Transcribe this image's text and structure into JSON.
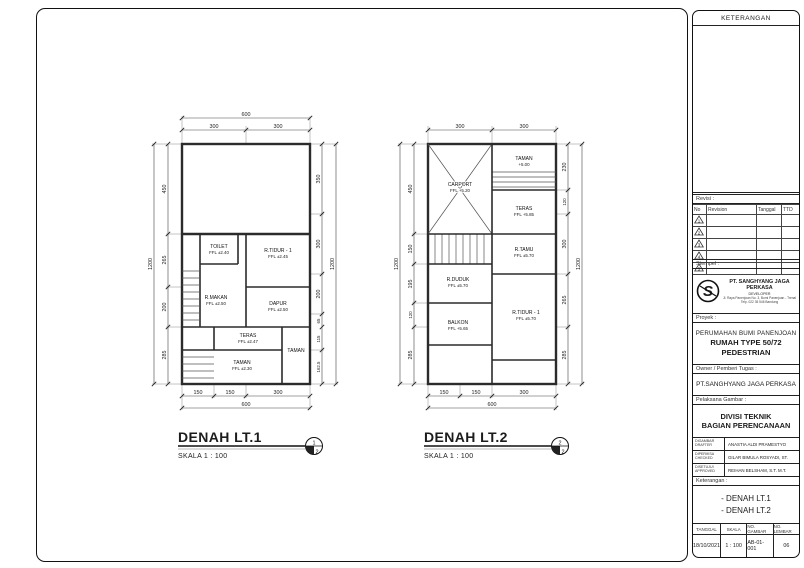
{
  "plan1": {
    "title": "DENAH LT.1",
    "scale": "SKALA 1 : 100",
    "ref_top": "1",
    "ref_bottom": "2",
    "dims": {
      "top_total": "600",
      "top": [
        "300",
        "300"
      ],
      "left_total": "1200",
      "left": [
        "450",
        "265",
        "200",
        "285"
      ],
      "right": [
        "350",
        "300",
        "200",
        "65",
        "115",
        "162.5"
      ],
      "right_total": "1200",
      "bottom": [
        "150",
        "150",
        "300"
      ],
      "bottom_total": "600"
    },
    "rooms": {
      "toilet": {
        "name": "TOILET",
        "ffl": "FFL ±2.40"
      },
      "rtidur": {
        "name": "R.TIDUR - 1",
        "ffl": "FFL ±2.45"
      },
      "dapur": {
        "name": "DAPUR",
        "ffl": "FFL ±2.50"
      },
      "rmakan": {
        "name": "R.MAKAN",
        "ffl": "FFL ±2.50"
      },
      "teras": {
        "name": "TERAS",
        "ffl": "FFL ±2.47"
      },
      "taman": {
        "name": "TAMAN",
        "ffl": "FFL ±2.30"
      },
      "taman2": {
        "name": "TAMAN",
        "ffl": ""
      }
    }
  },
  "plan2": {
    "title": "DENAH LT.2",
    "scale": "SKALA 1 : 100",
    "ref_top": "2",
    "ref_bottom": "2",
    "dims": {
      "top": [
        "300",
        "300"
      ],
      "left_total": "1200",
      "left": [
        "450",
        "150",
        "195",
        "120",
        "285"
      ],
      "right": [
        "230",
        "120",
        "300",
        "265",
        "285"
      ],
      "right_total": "1200",
      "bottom": [
        "150",
        "150",
        "300"
      ],
      "bottom_total": "600"
    },
    "rooms": {
      "taman": {
        "name": "TAMAN",
        "ffl": "+5.00"
      },
      "carport": {
        "name": "CARPORT",
        "ffl": "FFL +5.20"
      },
      "teras": {
        "name": "TERAS",
        "ffl": "FFL +5.85"
      },
      "rtamu": {
        "name": "R.TAMU",
        "ffl": "FFL ±5.70"
      },
      "rduduk": {
        "name": "R.DUDUK",
        "ffl": "FFL ±5.70"
      },
      "rtidur": {
        "name": "R.TIDUR - 1",
        "ffl": "FFL ±5.70"
      },
      "balkon": {
        "name": "BALKON",
        "ffl": "FFL +5.65"
      }
    }
  },
  "titleblock": {
    "keterangan_label": "KETERANGAN",
    "revisi_label": "Revisi :",
    "rev_cols": [
      "No",
      "Revision",
      "Tanggal",
      "TTD"
    ],
    "rev_markers": [
      "1",
      "2",
      "3",
      "4",
      "5"
    ],
    "stempel_label": "Stempel :",
    "company": {
      "name": "PT. SANGHYANG JAGA PERKASA",
      "role": "DEVELOPER",
      "addr1": "Jl. Raya Panenjoan No. 3, Bumi Panenjoan - Trenal",
      "addr2": "Telp. 022 35 546 Bandung"
    },
    "proyek_label": "Proyek :",
    "project": [
      "PERUMAHAN BUMI PANENJOAN",
      "RUMAH TYPE 50/72",
      "PEDESTRIAN"
    ],
    "owner_label": "Owner / Pemberi Tugas :",
    "owner": "PT.SANGHYANG JAGA PERKASA",
    "divisi_label": "Pelaksana Gambar :",
    "divisi": [
      "DIVISI TEKNIK",
      "BAGIAN PERENCANAAN"
    ],
    "sign_rows": [
      {
        "label1": "DIGAMBAR",
        "label2": "DRAFTER",
        "name": "ANASTIA ALDI PRAMESTYO"
      },
      {
        "label1": "DIPERIKSA",
        "label2": "CHECKED",
        "name": "GILAR BIMULA ROSYADI, ST."
      },
      {
        "label1": "DISETUJUI",
        "label2": "APPROVED",
        "name": "REIHAN BELSHAM, S.T. M.T."
      }
    ],
    "judul_label": "Keterangan :",
    "judul": [
      "- DENAH LT.1",
      "- DENAH LT.2"
    ],
    "footer": {
      "cols": [
        "TANGGAL",
        "SKALA",
        "NO. GAMBAR",
        "NO. LEMBAR"
      ],
      "values": [
        "18/10/2021",
        "1 : 100",
        "AB-01-001",
        "06"
      ]
    }
  }
}
